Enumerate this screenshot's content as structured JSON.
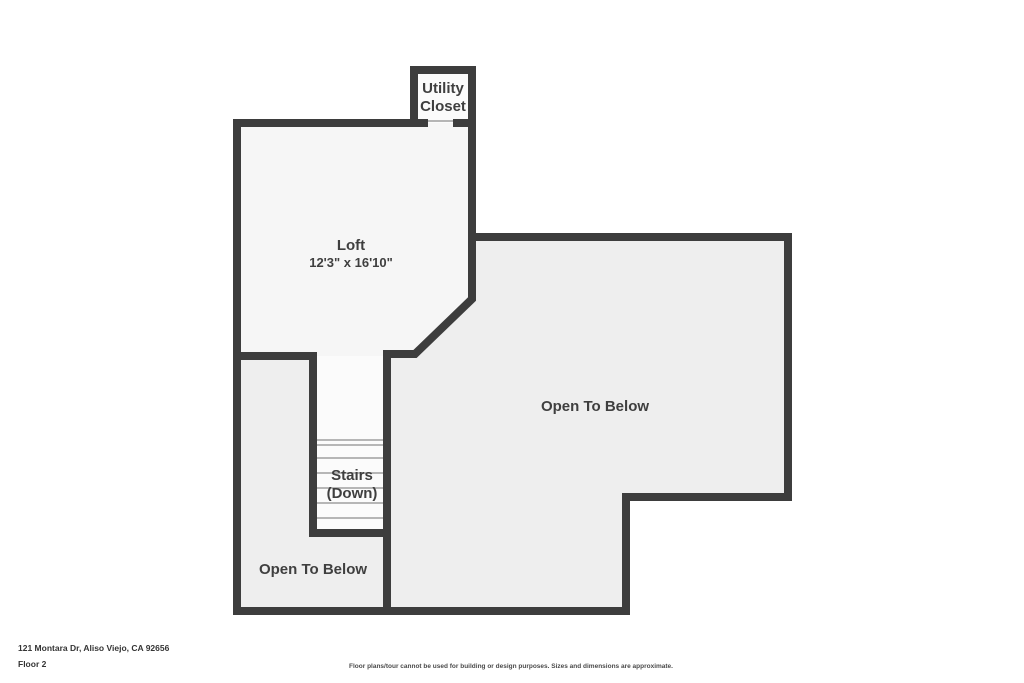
{
  "plan": {
    "rooms": {
      "utility_closet": {
        "label_line1": "Utility",
        "label_line2": "Closet"
      },
      "loft": {
        "label": "Loft",
        "dimensions": "12'3\" x 16'10\""
      },
      "stairs": {
        "label_line1": "Stairs",
        "label_line2": "(Down)"
      },
      "open_to_below_right": {
        "label": "Open To Below"
      },
      "open_to_below_left": {
        "label": "Open To Below"
      }
    },
    "colors": {
      "wall": "#3d3d3d",
      "loft_floor": "#f6f6f6",
      "gray_floor": "#eeeeee",
      "white_floor": "#fbfbfb",
      "tread_line": "#a0a0a0",
      "label_text": "#3f3f3f"
    }
  },
  "footer": {
    "address": "121 Montara Dr, Aliso Viejo, CA 92656",
    "floor_label": "Floor 2",
    "disclaimer": "Floor plans/tour cannot be used for building or design purposes. Sizes and dimensions are approximate."
  }
}
